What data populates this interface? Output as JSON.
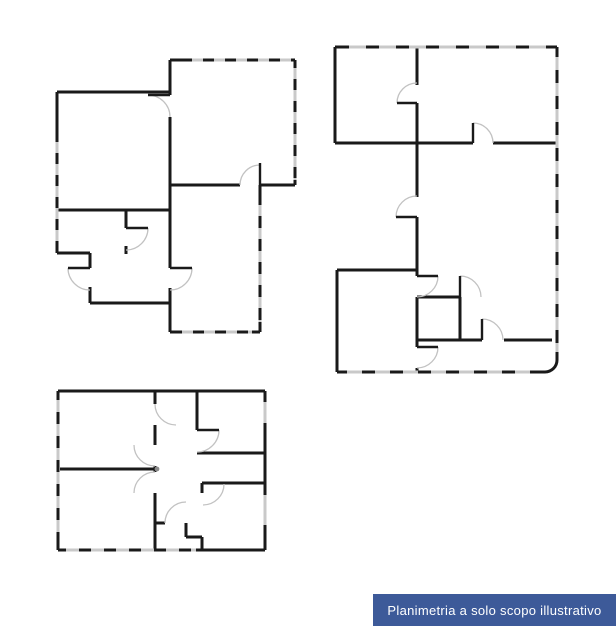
{
  "canvas": {
    "width": 616,
    "height": 626,
    "background": "#ffffff"
  },
  "colors": {
    "wall": "#1a1a1a",
    "window": "#c9c9c9",
    "arc": "#c2c2c2",
    "knob": "#8a8a8a",
    "label_bg": "#3d5a99",
    "label_text": "#ffffff"
  },
  "footer": {
    "label": "Planimetria a solo scopo illustrativo"
  },
  "plans": [
    {
      "name": "floorplan-top-left",
      "walls": [
        [
          57,
          92,
          170,
          92
        ],
        [
          170,
          60,
          170,
          95
        ],
        [
          170,
          117,
          170,
          268
        ],
        [
          170,
          288,
          170,
          332
        ],
        [
          170,
          60,
          295,
          60
        ],
        [
          295,
          60,
          295,
          185
        ],
        [
          170,
          185,
          240,
          185
        ],
        [
          260,
          185,
          295,
          185
        ],
        [
          260,
          185,
          260,
          332
        ],
        [
          170,
          332,
          260,
          332
        ],
        [
          57,
          92,
          57,
          253
        ],
        [
          57,
          210,
          170,
          210
        ],
        [
          57,
          253,
          90,
          253
        ],
        [
          90,
          253,
          90,
          268
        ],
        [
          90,
          287,
          90,
          303
        ],
        [
          90,
          303,
          170,
          303
        ],
        [
          126,
          210,
          126,
          228
        ],
        [
          126,
          246,
          126,
          254
        ]
      ],
      "windows": [
        {
          "seg": [
            192,
            60,
            293,
            60
          ],
          "dash": "11 11"
        },
        {
          "seg": [
            295,
            68,
            295,
            180
          ],
          "dash": "11 11"
        },
        {
          "seg": [
            260,
            205,
            260,
            322
          ],
          "dash": "11 12"
        },
        {
          "seg": [
            182,
            332,
            252,
            332
          ],
          "dash": "11 11"
        },
        {
          "seg": [
            57,
            142,
            57,
            251
          ],
          "dash": "11 11"
        }
      ],
      "leaves": [
        [
          148,
          95,
          170,
          95
        ],
        [
          260,
          163,
          260,
          185
        ],
        [
          170,
          268,
          192,
          268
        ],
        [
          68,
          268,
          90,
          268
        ],
        [
          126,
          228,
          148,
          228
        ]
      ],
      "arcs": [
        "M 148 95 A 22 22 0 0 1 170 117",
        "M 240 185 A 20 20 0 0 1 260 165",
        "M 192 268 A 22 22 0 0 1 170 290",
        "M 68 268 A 22 22 0 0 0 90 290",
        "M 148 228 A 22 22 0 0 1 126 250"
      ],
      "paths": [],
      "dots": []
    },
    {
      "name": "floorplan-right",
      "walls": [
        [
          335,
          47,
          557,
          47
        ],
        [
          335,
          47,
          335,
          143
        ],
        [
          335,
          143,
          473,
          143
        ],
        [
          493,
          143,
          557,
          143
        ],
        [
          417,
          47,
          417,
          85
        ],
        [
          417,
          103,
          417,
          197
        ],
        [
          417,
          217,
          417,
          276
        ],
        [
          417,
          297,
          417,
          347
        ],
        [
          417,
          368,
          417,
          373
        ],
        [
          337,
          270,
          417,
          270
        ],
        [
          337,
          270,
          337,
          372
        ],
        [
          337,
          372,
          545,
          372
        ],
        [
          557,
          47,
          557,
          360
        ],
        [
          417,
          297,
          460,
          297
        ],
        [
          460,
          297,
          460,
          340
        ],
        [
          417,
          340,
          482,
          340
        ],
        [
          504,
          340,
          552,
          340
        ]
      ],
      "windows": [
        {
          "seg": [
            349,
            47,
            550,
            47
          ],
          "dash": "17 13"
        },
        {
          "seg": [
            557,
            57,
            557,
            352
          ],
          "dash": "13 13"
        },
        {
          "seg": [
            347,
            372,
            540,
            372
          ],
          "dash": "15 13"
        }
      ],
      "leaves": [
        [
          397,
          103,
          417,
          103
        ],
        [
          396,
          217,
          417,
          217
        ],
        [
          473,
          123,
          473,
          143
        ],
        [
          417,
          276,
          438,
          276
        ],
        [
          460,
          276,
          460,
          297
        ],
        [
          482,
          319,
          482,
          340
        ],
        [
          417,
          347,
          438,
          347
        ]
      ],
      "arcs": [
        "M 397 103 A 20 20 0 0 1 417 83",
        "M 396 217 A 21 21 0 0 1 417 196",
        "M 473 123 A 20 20 0 0 1 493 143",
        "M 438 276 A 21 21 0 0 1 417 297",
        "M 460 276 A 21 21 0 0 1 481 297",
        "M 482 319 A 21 21 0 0 1 503 340",
        "M 438 347 A 21 21 0 0 1 417 368"
      ],
      "paths": [
        "M 545 372 A 12 12 0 0 0 557 360"
      ],
      "dots": []
    },
    {
      "name": "floorplan-bottom-left",
      "walls": [
        [
          58,
          391,
          265,
          391
        ],
        [
          58,
          391,
          58,
          550
        ],
        [
          58,
          550,
          265,
          550
        ],
        [
          265,
          391,
          265,
          550
        ],
        [
          60,
          469,
          156,
          469
        ],
        [
          155,
          391,
          155,
          404
        ],
        [
          155,
          425,
          155,
          445
        ],
        [
          155,
          466,
          155,
          472
        ],
        [
          155,
          493,
          155,
          550
        ],
        [
          197,
          391,
          197,
          430
        ],
        [
          197,
          453,
          265,
          453
        ],
        [
          202,
          483,
          265,
          483
        ],
        [
          202,
          483,
          202,
          493
        ],
        [
          155,
          523,
          165,
          523
        ],
        [
          186,
          523,
          186,
          537
        ],
        [
          186,
          537,
          202,
          537
        ],
        [
          202,
          537,
          202,
          550
        ]
      ],
      "windows": [
        {
          "seg": [
            58,
            400,
            58,
            542
          ],
          "dash": "12 12"
        },
        {
          "seg": [
            66,
            550,
            196,
            550
          ],
          "dash": "13 12"
        },
        {
          "seg": [
            265,
            402,
            265,
            423
          ]
        },
        {
          "seg": [
            265,
            495,
            265,
            525
          ]
        }
      ],
      "leaves": [
        [
          197,
          430,
          219,
          430
        ]
      ],
      "arcs": [
        "M 155 404 A 21 21 0 0 0 176 425",
        "M 134 445 A 21 21 0 0 0 155 466",
        "M 134 493 A 21 21 0 0 1 155 472",
        "M 219 430 A 22 22 0 0 1 197 452",
        "M 224 484 A 21 21 0 0 1 203 505",
        "M 165 523 A 21 21 0 0 1 186 502"
      ],
      "paths": [],
      "dots": [
        [
          157,
          469
        ]
      ]
    }
  ]
}
